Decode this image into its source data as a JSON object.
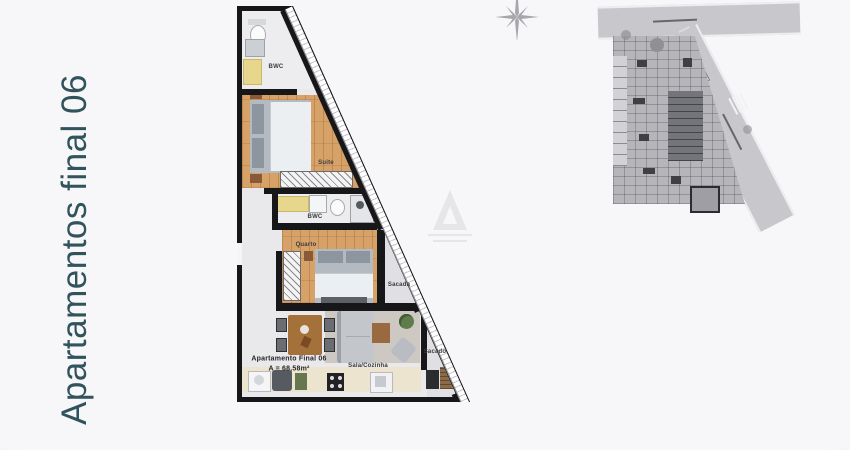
{
  "side_label": {
    "text": "Apartamentos final 06",
    "color": "#30535c"
  },
  "plan": {
    "rooms": {
      "bwc_top": "BWC",
      "suite": "Suite",
      "bwc_mid": "BWC",
      "quarto": "Quarto",
      "sacada": "Sacada",
      "sala": "Sala/Cozinha",
      "sacado": "Sacado"
    },
    "unit": {
      "name": "Apartamento Final 06",
      "area": "A = 68,58m²"
    }
  },
  "colors": {
    "accent_teal": "#30535c",
    "wall": "#17171a",
    "wood_floor": "#d6a268",
    "tile_floor": "#ededef",
    "balcony_floor": "#e0e0e4",
    "kitchen_counter": "#ece4cf",
    "site_road": "#c8c8cc",
    "background": "#f6f6f8"
  },
  "icons": {
    "compass": "north-star-compass-icon",
    "watermark": "builder-logo-watermark"
  }
}
